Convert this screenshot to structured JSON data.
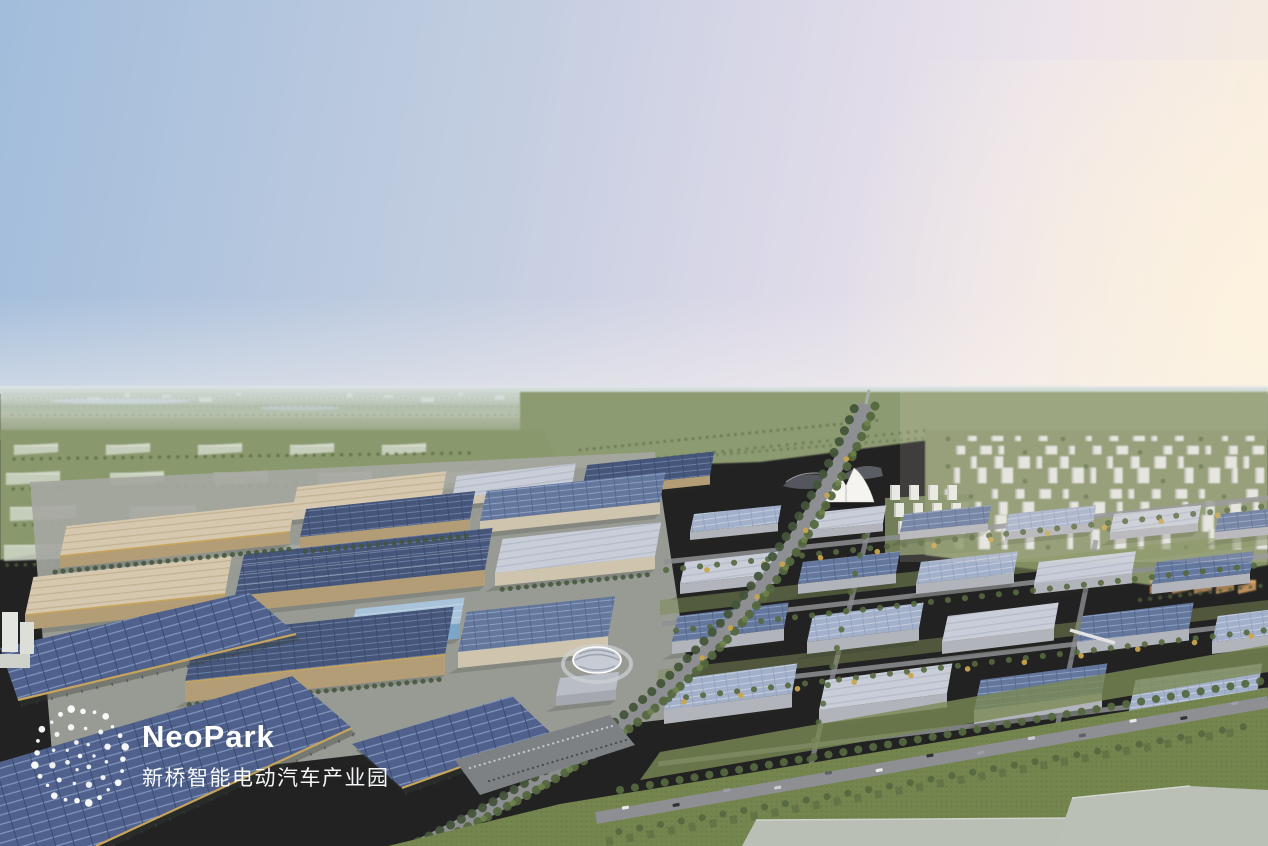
{
  "logo": {
    "brand": "NeoPark",
    "subtitle": "新桥智能电动汽车产业园",
    "mark_icon": "dot-cluster-logo-icon",
    "color": "#ffffff"
  },
  "palette": {
    "sky_blue": "#a2bddb",
    "sky_mid": "#c2cde0",
    "sky_lavender": "#dcd9e8",
    "sky_pink": "#ece4eb",
    "sky_peach": "#f7ecde",
    "sun_glow": "#fff4df",
    "horizon_haze": "#dde6e9",
    "far_field": "#97a483",
    "field_light": "#aab394",
    "field_green": "#8d9b72",
    "ghost_building": "#cdd5c5",
    "lawn": "#75854e",
    "lawn_dark": "#637348",
    "lawn_shadow": "#52613f",
    "tree": "#55683f",
    "tree_dark": "#43553a",
    "tree_autumn": "#c8a54e",
    "roof_tan": "#d5c8ae",
    "roof_stripe": "#c2b293",
    "wall_tan": "#b39d77",
    "wall_light": "#cfc4ad",
    "trim_gold": "#c7a45c",
    "solar_deep": "#46567a",
    "solar_deep_line": "#6b7ea4",
    "solar_mid": "#64779d",
    "solar_mid_line": "#8ea1c2",
    "solar_pale": "#a3b0ca",
    "solar_pale_line": "#c4cede",
    "roof_gray": "#c8cdd7",
    "roof_gray_line": "#b4bac8",
    "wall_gray": "#b2b4bb",
    "white_building": "#e3e5e0",
    "building_shade": "#b9bdb4",
    "road": "#8d8f92",
    "apron": "#a5a7a1",
    "carport_blue": "#4f618c",
    "carport_line": "#8094ba",
    "carport_dark": "#3c4c72",
    "glass_wall": "#7ca6c8",
    "glass_roof": "#a9c3da",
    "expo_dark": "#53565c",
    "tent_white": "#f5f4f0",
    "slab": "#b9bfb5",
    "water": "#b6c3cd",
    "logo_white": "#ffffff"
  }
}
